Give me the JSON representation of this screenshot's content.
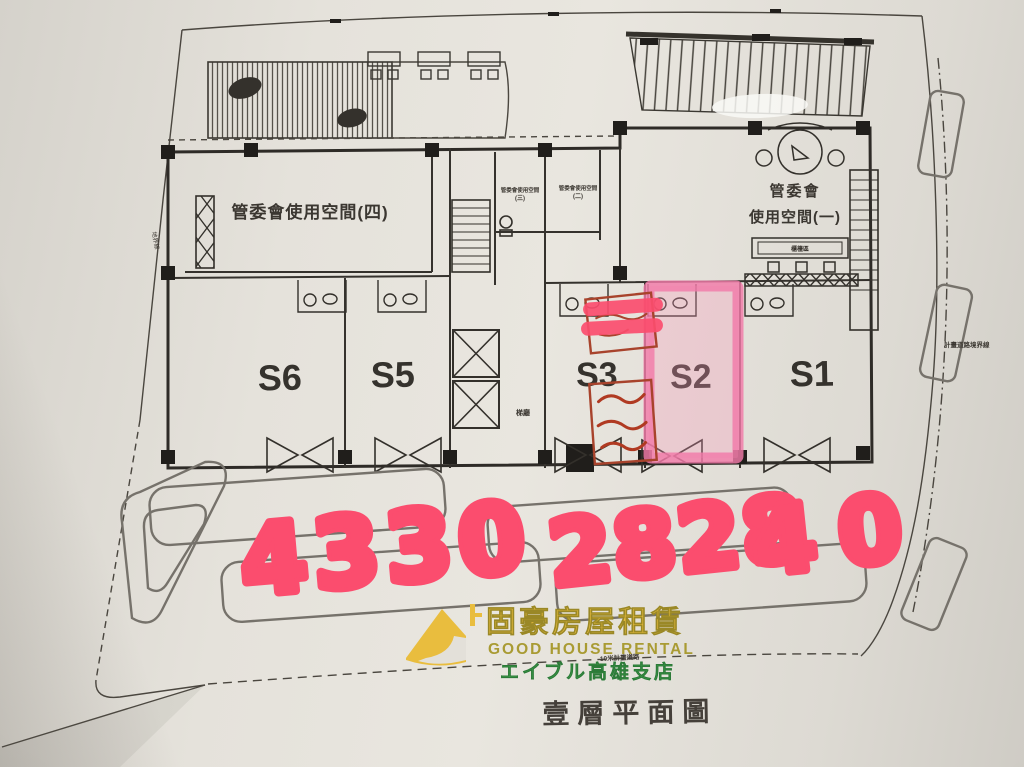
{
  "plan": {
    "title": "壹層平面圖",
    "rooms": {
      "room4": "管委會使用空間(四)",
      "room1_line1": "管委會",
      "room1_line2": "使用空間(一)",
      "room23_prefix": "管委會使用空間",
      "room3_suffix": "(三)",
      "room2_suffix": "(二)",
      "elevator_hall": "梯廳",
      "counter": "櫃檯區"
    },
    "units": [
      {
        "label": "S6",
        "highlighted": false
      },
      {
        "label": "S5",
        "highlighted": false
      },
      {
        "label": "S3",
        "highlighted": false
      },
      {
        "label": "S2",
        "highlighted": true
      },
      {
        "label": "S1",
        "highlighted": false
      }
    ],
    "boundary_labels": {
      "left": "地界線",
      "right": "計畫道路境界線",
      "bottom": "10米計畫道路"
    }
  },
  "annotations": {
    "handwritten_left": "4330",
    "handwritten_mid": "2828",
    "handwritten_right": "40",
    "marker_color": "#fb4d6e",
    "highlight_color": "#f27aa8",
    "stamp_color": "#a8432c"
  },
  "logo": {
    "name_zh": "固豪房屋租賃",
    "name_en": "GOOD HOUSE RENTAL",
    "branch": "エイブル高雄支店",
    "yellow": "#e9bd3e",
    "green": "#3fa04c"
  }
}
